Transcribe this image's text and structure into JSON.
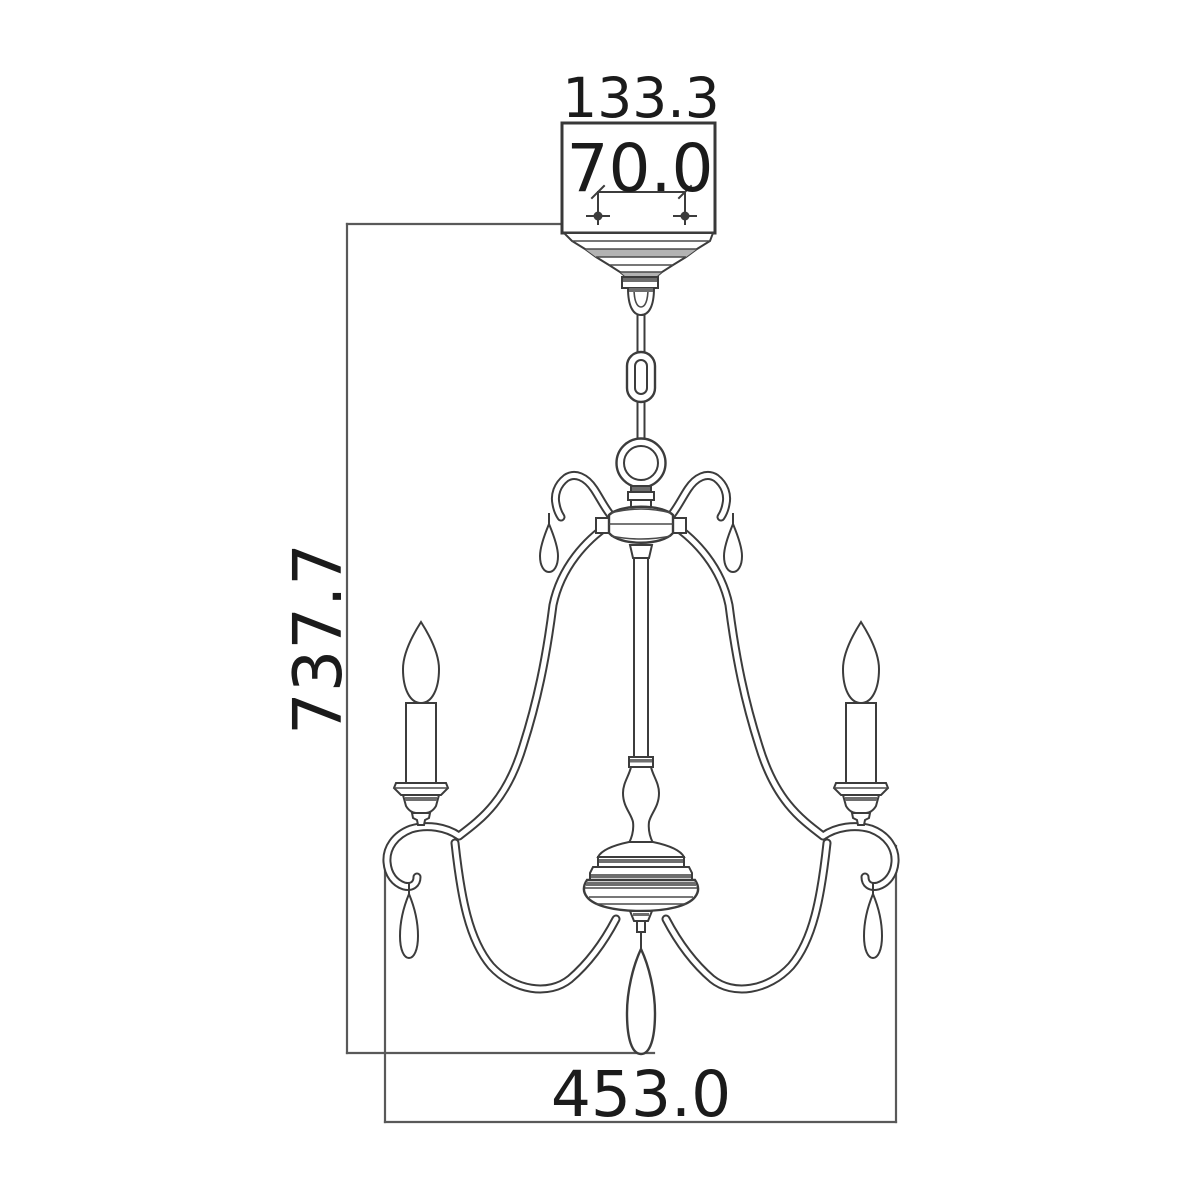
{
  "diagram": {
    "type": "technical dimension drawing",
    "subject": "chandelier elevation with suspension chain, scrolled arms, candle lights and teardrop crystals",
    "background_color": "#ffffff",
    "geometry_line_color": "#3c3c3c",
    "dimension_line_color": "#595959",
    "text_color": "#1b1b1b",
    "dimensions": {
      "canopy_width": "133.3",
      "mounting_hole_spacing": "70.0",
      "overall_height": "737.7",
      "overall_width": "453.0"
    }
  }
}
